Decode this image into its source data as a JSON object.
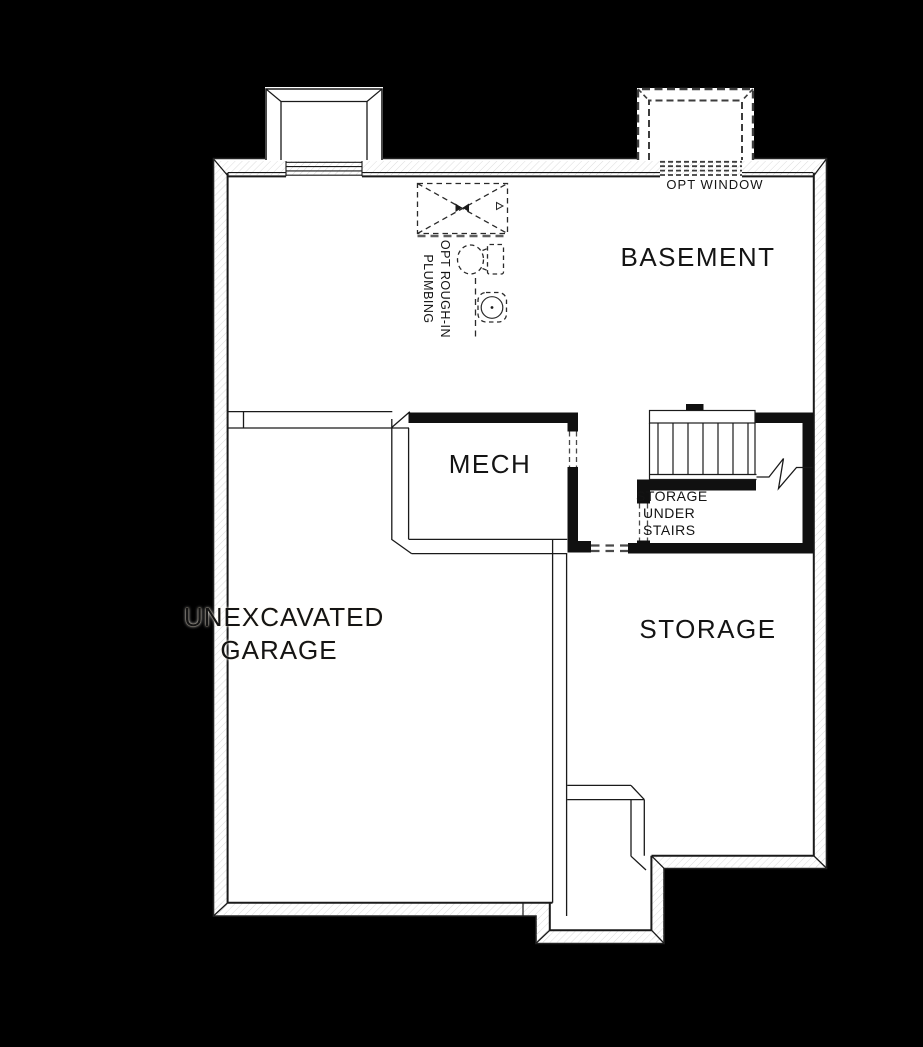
{
  "colors": {
    "background": "#000000",
    "paper": "#ffffff",
    "line": "#1a1a1a",
    "dash": "#444444",
    "text": "#141414"
  },
  "labels": {
    "basement": "BASEMENT",
    "mech": "MECH",
    "storage": "STORAGE",
    "storage_under_stairs": [
      "STORAGE",
      "UNDER",
      "STAIRS"
    ],
    "garage": [
      "UNEXCAVATED",
      "GARAGE"
    ],
    "opt_window": "OPT WINDOW",
    "opt_rough_in": [
      "OPT ROUGH-IN",
      "PLUMBING"
    ]
  },
  "fixtures": {
    "shower": "opt-shower-rough-in",
    "toilet": "opt-toilet-rough-in",
    "sink": "opt-sink-rough-in",
    "stairs": "basement-stairs",
    "window_well_left": "window-well",
    "window_well_right": "opt-window-well"
  }
}
